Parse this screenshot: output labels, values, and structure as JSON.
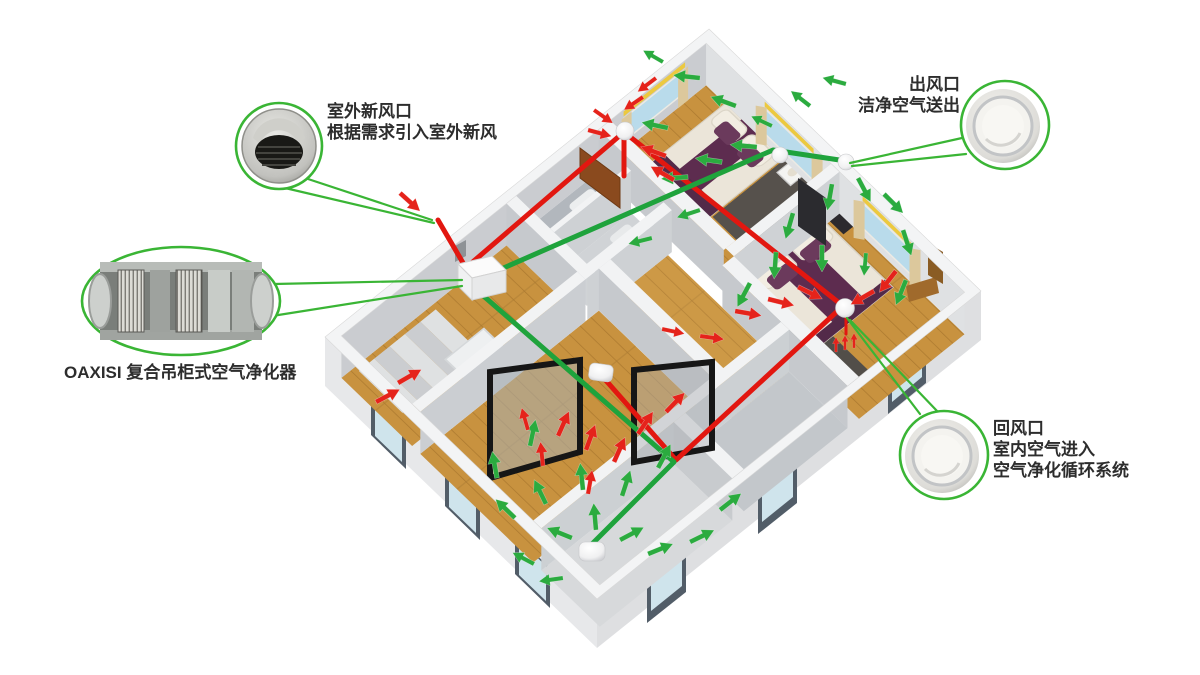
{
  "colors": {
    "supply_green": "#1fa33c",
    "return_red": "#e21710",
    "callout_green": "#3ab535",
    "label_text": "#2d2d2d"
  },
  "callouts": {
    "fresh_air_inlet": {
      "line1": "室外新风口",
      "line2": "根据需求引入室外新风",
      "photo": "outdoor-cowl-vent-photo"
    },
    "purifier": {
      "label": "OAXISI 复合吊柜式空气净化器",
      "photo": "duct-air-purifier-cutaway-photo"
    },
    "supply_outlet": {
      "line1": "出风口",
      "line2": "洁净空气送出",
      "photo": "round-ceiling-diffuser-photo"
    },
    "return_inlet": {
      "line1": "回风口",
      "line2": "室内空气进入",
      "line3": "空气净化循环系统",
      "photo": "round-ceiling-diffuser-photo"
    }
  }
}
